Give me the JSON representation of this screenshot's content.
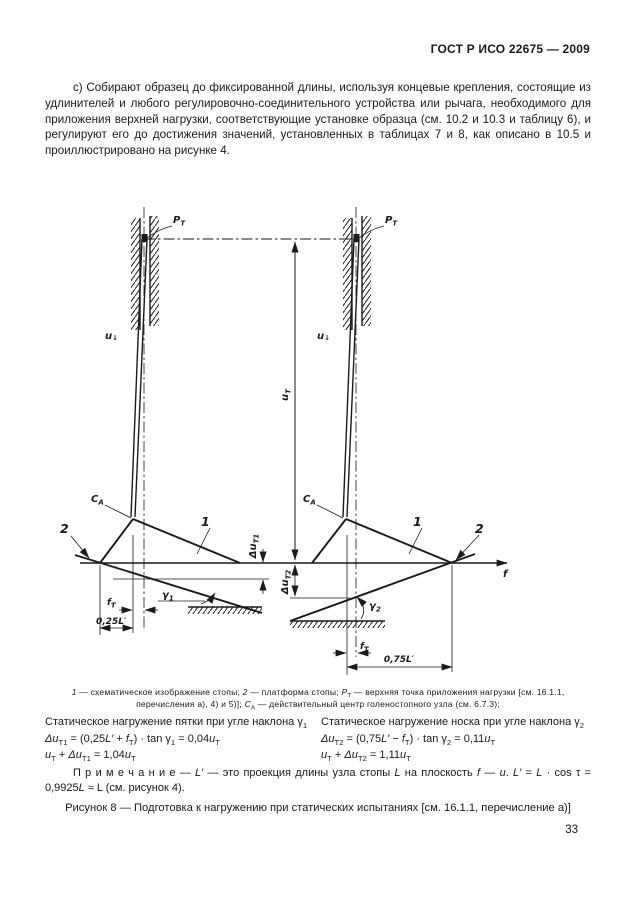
{
  "page": {
    "header": "ГОСТ Р ИСО 22675 — 2009",
    "number": "33"
  },
  "intro": {
    "text": "с) Собирают образец до фиксированной длины, используя концевые крепления, состоящие из удлинителей и любого регулировочно-соединительного устройства или рычага, необходимого для приложения верхней нагрузки, соответствующие установке образца (см. 10.2 и 10.3 и таблицу 6), и регулируют его до достижения значений, установленных в таблицах 7 и 8, как описано в 10.5 и проиллюстрировано на рисунке 4."
  },
  "figure": {
    "labels": {
      "pt_base": "P",
      "pt_sub": "Т",
      "ca_base": "C",
      "ca_sub": "А",
      "one": "1",
      "two": "2",
      "u_base": "u",
      "u_arrow": "↓",
      "ut_base": "u",
      "ut_sub": "Т",
      "dut1_base": "Δu",
      "dut1_sub": "Т1",
      "dut2_base": "Δu",
      "dut2_sub": "Т2",
      "g1_base": "γ",
      "g1_sub": "1",
      "g2_base": "γ",
      "g2_sub": "2",
      "ft_base": "f",
      "ft_sub": "Т",
      "dim_left": "0,25L′",
      "dim_right": "0,75L′",
      "axis_f": "f"
    },
    "legend_segments": [
      {
        "i": "1"
      },
      {
        "t": " — схематическое изображение стопы; "
      },
      {
        "i": "2"
      },
      {
        "t": " — платформа стопы; "
      },
      {
        "i": "P"
      },
      {
        "s": "Т"
      },
      {
        "t": " — верхняя точка приложения нагрузки [см. 16.1.1, перечисления а), 4) и 5)]; "
      },
      {
        "i": "C"
      },
      {
        "s": "А"
      },
      {
        "t": " — действительный центр голеностопного узла (см. 6.7.3);"
      }
    ],
    "caption": "Рисунок 8 — Подготовка к нагружению при статических испытаниях [см. 16.1.1, перечисление а)]"
  },
  "static_loading": {
    "left": {
      "title": [
        {
          "t": "Статическое нагружение пятки при угле наклона γ"
        },
        {
          "s": "1"
        }
      ],
      "formula1": [
        {
          "i": "Δu"
        },
        {
          "s": "Т1"
        },
        {
          "t": " = (0,25"
        },
        {
          "i": "L′"
        },
        {
          "t": " + "
        },
        {
          "i": "f"
        },
        {
          "s": "Т"
        },
        {
          "t": ") · tan γ"
        },
        {
          "s": "1"
        },
        {
          "t": " = 0,04"
        },
        {
          "i": "u"
        },
        {
          "s": "Т"
        }
      ],
      "formula2": [
        {
          "i": "u"
        },
        {
          "s": "Т"
        },
        {
          "t": " + "
        },
        {
          "i": "Δu"
        },
        {
          "s": "Т1"
        },
        {
          "t": " = 1,04"
        },
        {
          "i": "u"
        },
        {
          "s": "Т"
        }
      ]
    },
    "right": {
      "title": [
        {
          "t": "Статическое нагружение носка при угле наклона γ"
        },
        {
          "s": "2"
        }
      ],
      "formula1": [
        {
          "i": "Δu"
        },
        {
          "s": "Т2"
        },
        {
          "t": " = (0,75"
        },
        {
          "i": "L′"
        },
        {
          "t": " − "
        },
        {
          "i": "f"
        },
        {
          "s": "Т"
        },
        {
          "t": ") · tan γ"
        },
        {
          "s": "2"
        },
        {
          "t": " = 0,11"
        },
        {
          "i": "u"
        },
        {
          "s": "Т"
        }
      ],
      "formula2": [
        {
          "i": "u"
        },
        {
          "s": "Т"
        },
        {
          "t": " + "
        },
        {
          "i": "Δu"
        },
        {
          "s": "Т2"
        },
        {
          "t": " = 1,11"
        },
        {
          "i": "u"
        },
        {
          "s": "Т"
        }
      ]
    }
  },
  "note_segments": [
    {
      "t": "П р и м е ч а н и е — "
    },
    {
      "i": "L′"
    },
    {
      "t": " — это проекция длины узла стопы "
    },
    {
      "i": "L"
    },
    {
      "t": " на плоскость "
    },
    {
      "i": "f"
    },
    {
      "t": " — "
    },
    {
      "i": "u"
    },
    {
      "t": ". "
    },
    {
      "i": "L′"
    },
    {
      "t": " = "
    },
    {
      "i": "L"
    },
    {
      "t": " · cos τ = 0,9925"
    },
    {
      "i": "L"
    },
    {
      "t": " ≈ L (см. рисунок 4)."
    }
  ]
}
